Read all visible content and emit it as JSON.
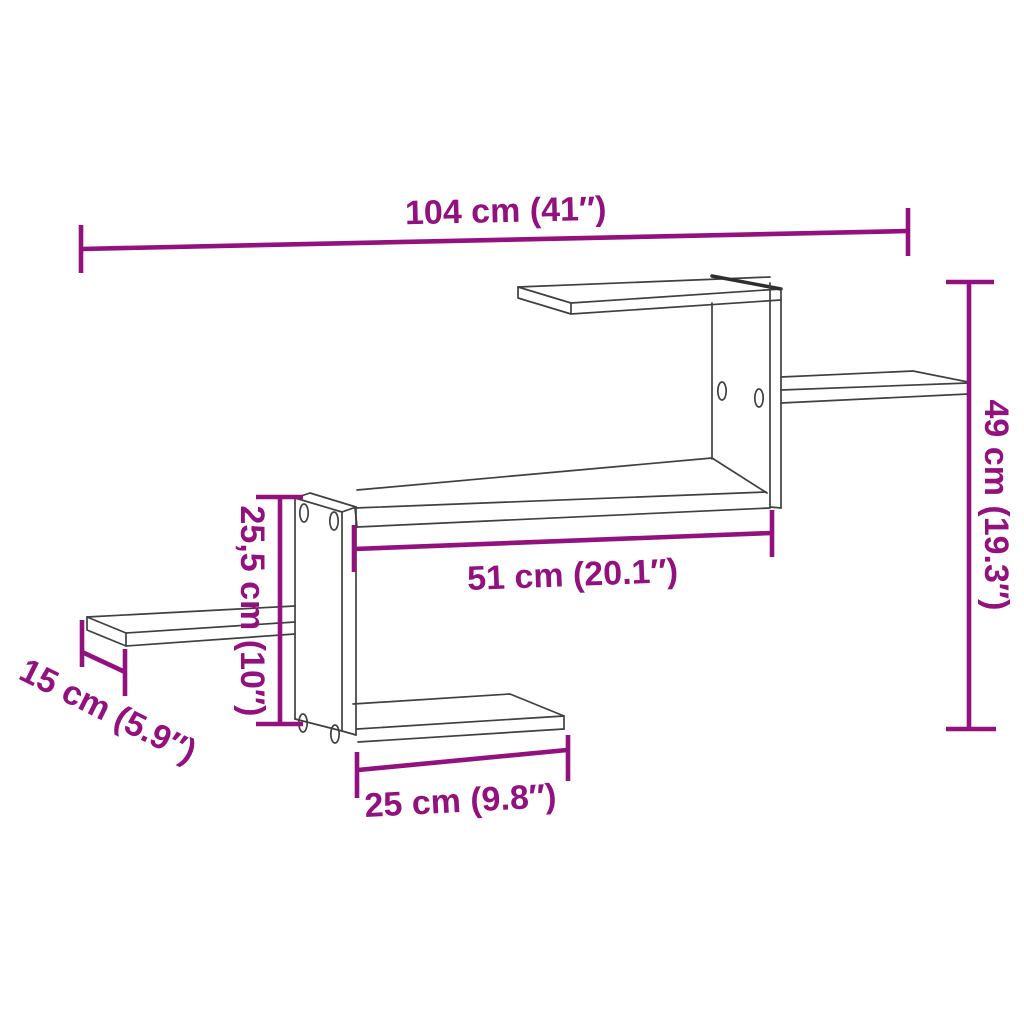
{
  "diagram": {
    "colors": {
      "dimension_annotation": "#93117F",
      "product_outline": "#404040",
      "background": "#FFFFFF"
    },
    "dimensions": {
      "total_width": "104 cm (41″)",
      "total_height": "49 cm (19.3″)",
      "left_section_height": "25,5 cm (10″)",
      "main_shelf_width": "51 cm (20.1″)",
      "side_shelf_depth": "15 cm (5.9″)",
      "bottom_shelf_width": "25 cm (9.8″)"
    }
  }
}
